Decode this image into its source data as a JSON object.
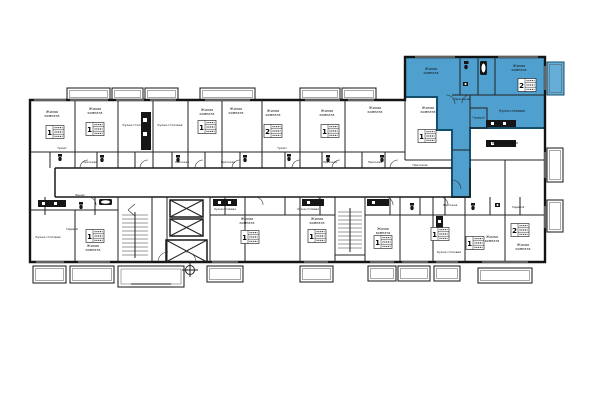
{
  "plan": {
    "background_color": "#ffffff",
    "wall_color": "#141414",
    "highlight_fill": "#4fa0cf",
    "highlight_stroke": "#14506e",
    "highlight_balcony_fill": "#66aed8",
    "labels": {
      "living": "Жилая комната",
      "kitchen": "Кухня-столовая",
      "hall": "Прихожая",
      "wardrobe": "Гардероб",
      "toilet": "Туалет",
      "bath": "Ванная"
    },
    "stamps": {
      "one": "1",
      "two": "2"
    }
  }
}
